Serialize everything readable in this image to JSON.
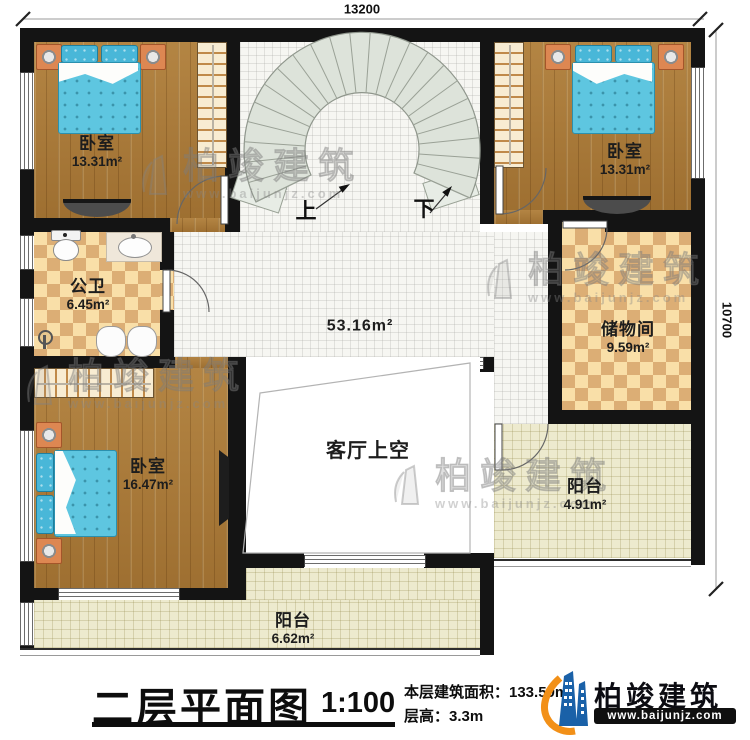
{
  "watermark": {
    "brand": "柏竣建筑",
    "site": "www.baijunjz.com"
  },
  "dimensions": {
    "top": "13200",
    "right": "10700"
  },
  "stairs": {
    "up": "上",
    "down": "下"
  },
  "rooms": {
    "bedroom_tl": {
      "name": "卧室",
      "area": "13.31m²"
    },
    "bedroom_tr": {
      "name": "卧室",
      "area": "13.31m²"
    },
    "bathroom": {
      "name": "公卫",
      "area": "6.45m²"
    },
    "hall": {
      "area": "53.16m²"
    },
    "storage": {
      "name": "储物间",
      "area": "9.59m²"
    },
    "bedroom_bl": {
      "name": "卧室",
      "area": "16.47m²"
    },
    "living_void": {
      "name": "客厅上空"
    },
    "balcony_right": {
      "name": "阳台",
      "area": "4.91m²"
    },
    "balcony_bottom": {
      "name": "阳台",
      "area": "6.62m²"
    }
  },
  "title_block": {
    "title": "二层平面图",
    "scale": "1:100",
    "area_note": "本层建筑面积：133.59m²",
    "height_note": "层高：3.3m",
    "logo_name": "柏竣建筑",
    "logo_site": "www.baijunjz.com"
  },
  "colors": {
    "brand_blue": "#1a61a8",
    "brand_orange": "#f29018",
    "wall": "#141414",
    "mattress": "#5ec6e0"
  }
}
